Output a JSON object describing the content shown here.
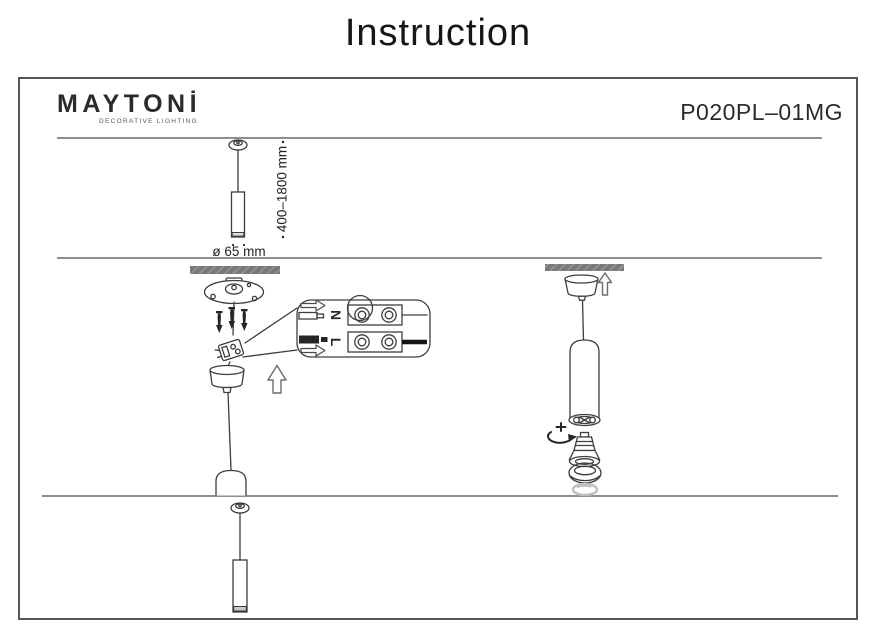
{
  "page": {
    "title": "Instruction"
  },
  "brand": {
    "name": "MAYTONİ",
    "tagline": "DECORATIVE LIGHTING"
  },
  "product": {
    "code": "P020PL–01MG"
  },
  "overview": {
    "height_range_label": "400–1800 mm",
    "diameter_label": "ø 65 mm"
  },
  "wiring_detail": {
    "neutral_label": "N",
    "live_label": "L"
  },
  "colors": {
    "ink": "#161616",
    "line_art": "#3d3d3d",
    "divider": "#8e8e8e",
    "ceiling_bar": "#7a7a7a",
    "faded_part": "#bfbfbf"
  }
}
